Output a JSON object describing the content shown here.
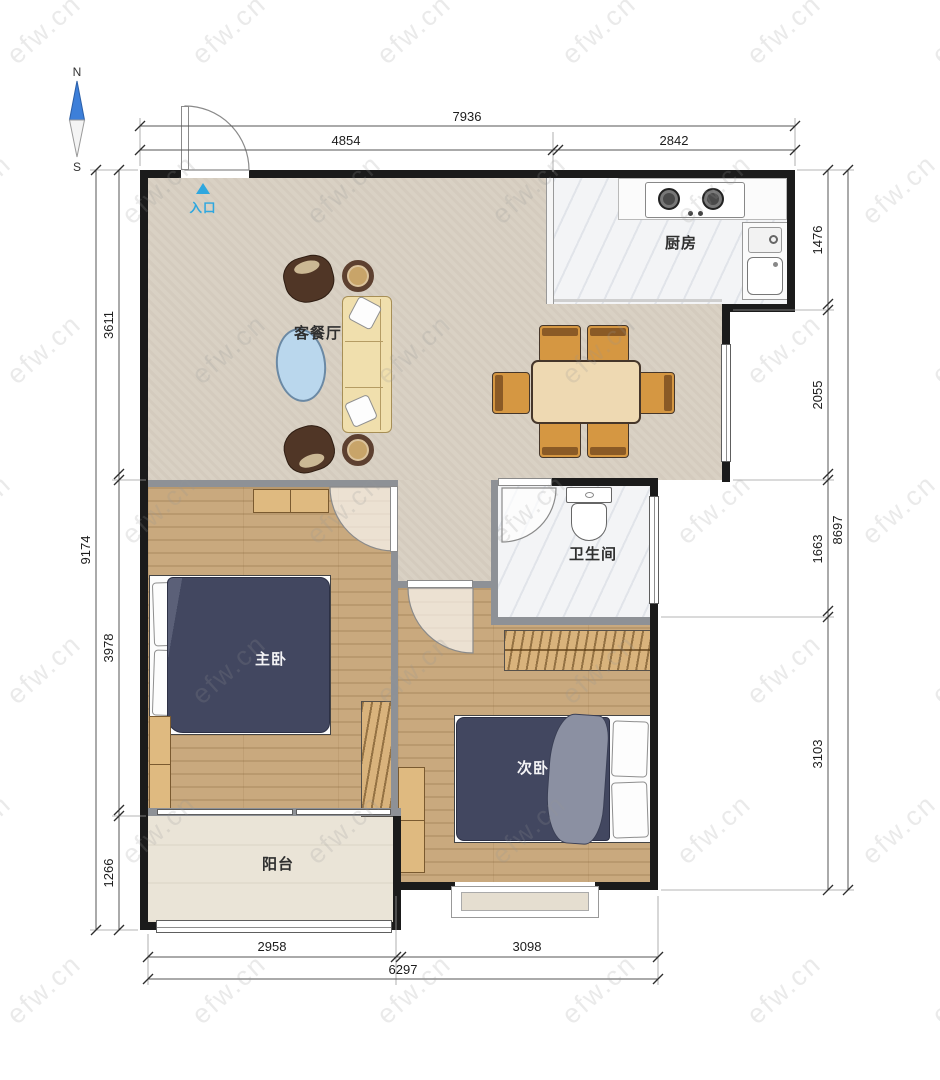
{
  "plan": {
    "compass": {
      "north": "N",
      "south": "S"
    },
    "entry_label": "入口",
    "rooms": {
      "living_dining": {
        "label": "客餐厅"
      },
      "kitchen": {
        "label": "厨房"
      },
      "bathroom": {
        "label": "卫生间"
      },
      "master_bedroom": {
        "label": "主卧"
      },
      "second_bedroom": {
        "label": "次卧"
      },
      "balcony": {
        "label": "阳台"
      }
    }
  },
  "dimensions_mm": {
    "top": {
      "overall": "7936",
      "segments": [
        "4854",
        "2842"
      ]
    },
    "bottom": {
      "overall": "6297",
      "segments": [
        "2958",
        "3098"
      ]
    },
    "left": {
      "overall": "9174",
      "segments": [
        "3611",
        "3978",
        "1266"
      ]
    },
    "right": {
      "overall": "8697",
      "segments": [
        "1476",
        "2055",
        "1663",
        "3103"
      ]
    }
  },
  "watermark": {
    "text": "efw.cn"
  },
  "colors": {
    "entry_blue": "#2ea7df",
    "wall_black": "#1b1b1b",
    "wall_gray": "#8e9196",
    "wood_floor": "#c9a97e",
    "bed_navy": "#424760",
    "chair_orange": "#d59742",
    "sofa_yellow": "#f0dfad",
    "coffee_table_blue": "#bad7ed"
  }
}
